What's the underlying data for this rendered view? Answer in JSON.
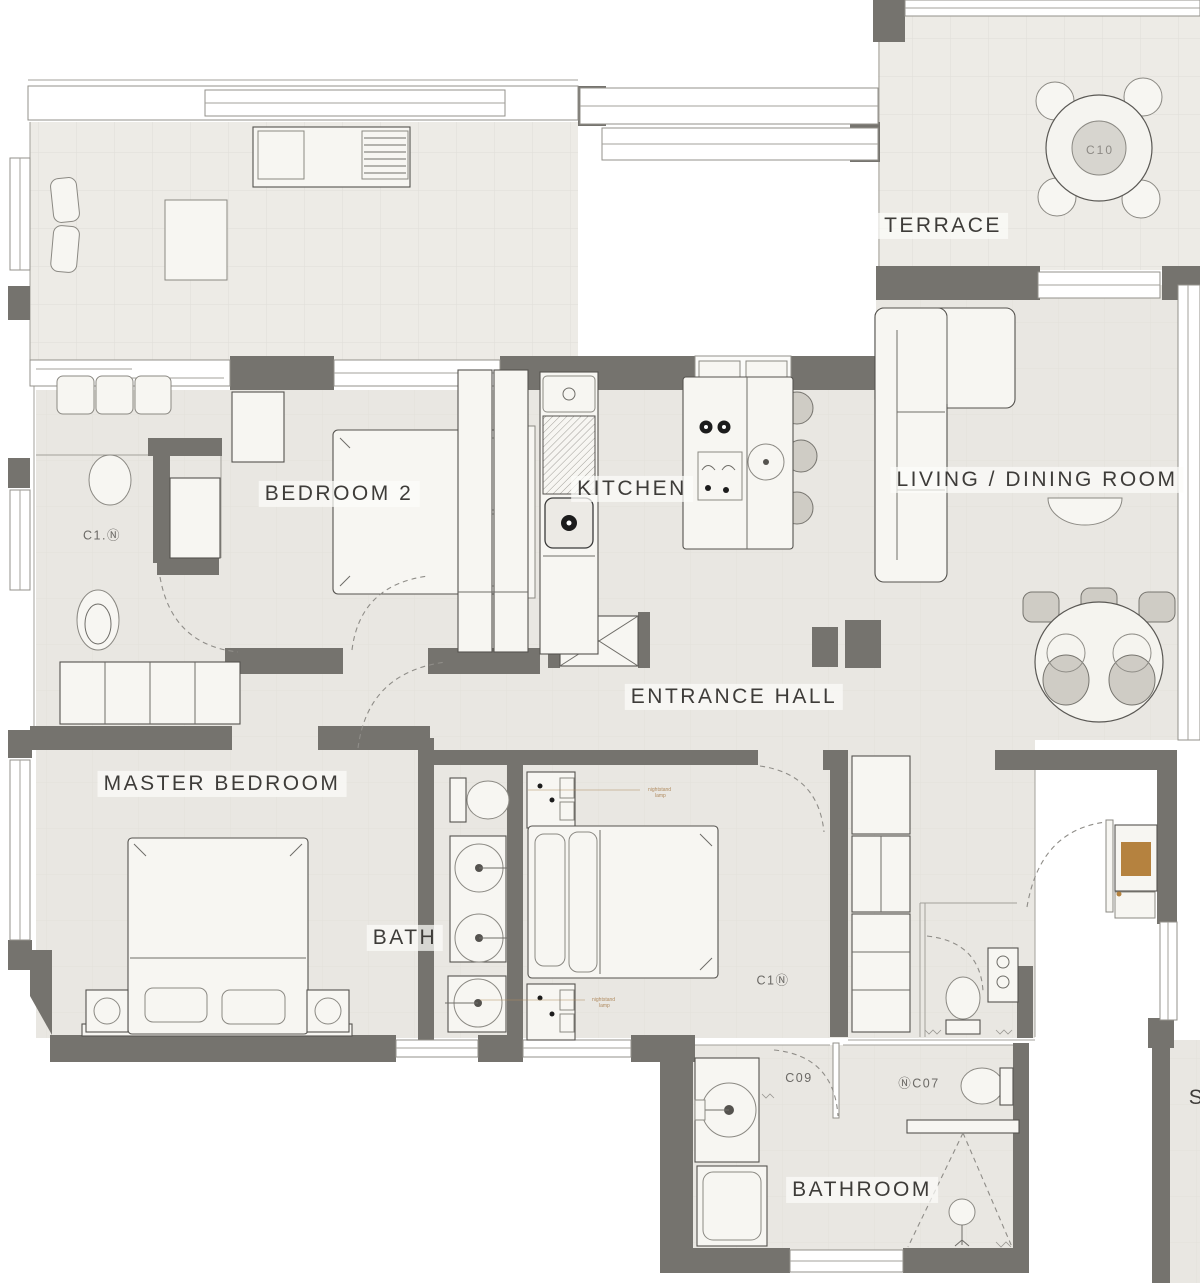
{
  "plan": {
    "rooms": [
      {
        "id": "terrace",
        "label": "TERRACE"
      },
      {
        "id": "bedroom2",
        "label": "BEDROOM 2"
      },
      {
        "id": "kitchen",
        "label": "KITCHEN"
      },
      {
        "id": "living_dining",
        "label": "LIVING / DINING ROOM"
      },
      {
        "id": "entrance_hall",
        "label": "ENTRANCE HALL"
      },
      {
        "id": "master_bedroom",
        "label": "MASTER BEDROOM"
      },
      {
        "id": "bath",
        "label": "BATH"
      },
      {
        "id": "bathroom",
        "label": "BATHROOM"
      },
      {
        "id": "partial_room",
        "label": "S"
      }
    ],
    "codes": [
      {
        "id": "c10",
        "text": "C10"
      },
      {
        "id": "c1n_wc",
        "text": "C1.Ⓝ"
      },
      {
        "id": "c1n_bedroom3",
        "text": "C1Ⓝ"
      },
      {
        "id": "c09",
        "text": "C09"
      },
      {
        "id": "c07",
        "text": "ⓃC07"
      }
    ],
    "annotations": [
      {
        "id": "lamp_note_top",
        "line1": "nightstand",
        "line2": "lamp"
      },
      {
        "id": "lamp_note_bottom",
        "line1": "nightstand",
        "line2": "lamp"
      }
    ],
    "colors": {
      "wall": "#75736e",
      "floor": "#e9e7e2",
      "terrace_floor": "#edebe6",
      "furniture": "#f7f6f2",
      "chair": "#cfccc5",
      "accent_wood": "#b5823f",
      "annotation": "#b08b5f",
      "label_text": "#3e3c39"
    }
  }
}
